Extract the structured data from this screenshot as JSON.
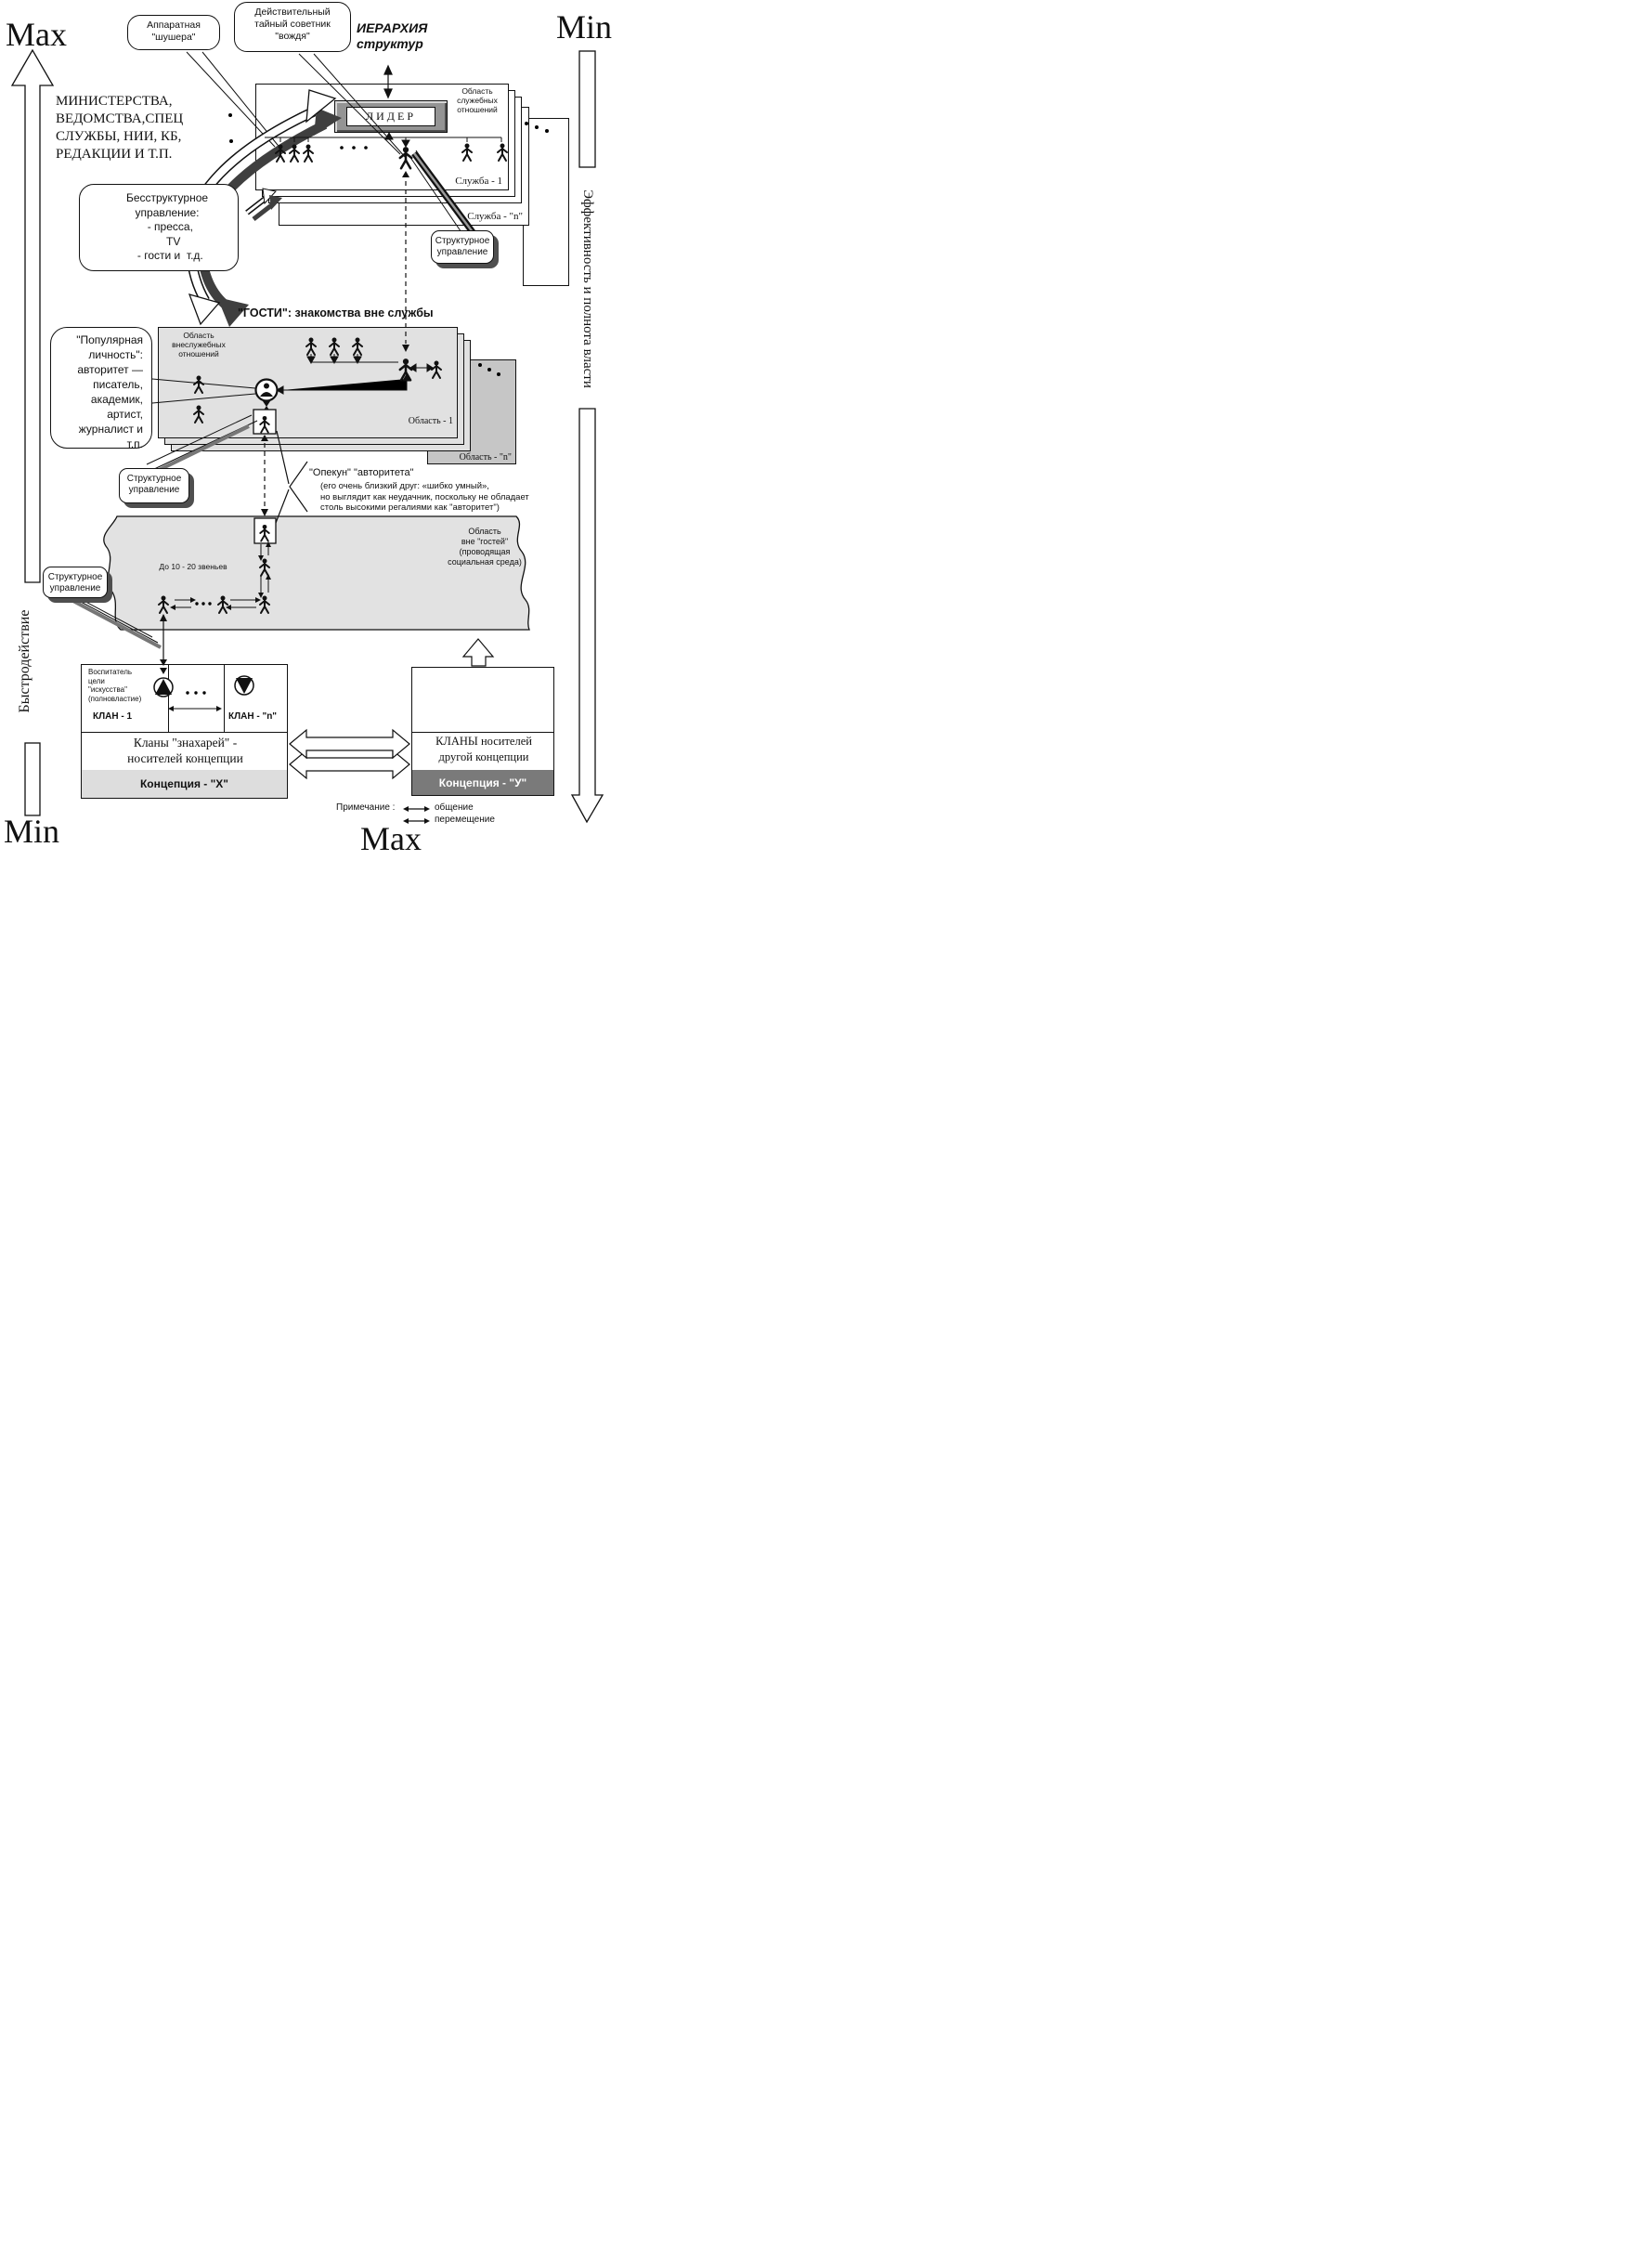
{
  "axes": {
    "left": {
      "top": "Max",
      "label": "Быстродействие",
      "bottom": "Min"
    },
    "right": {
      "top": "Min",
      "label": "Эффективность и полнота власти",
      "bottom": "Max"
    }
  },
  "callouts": {
    "apparat": "Аппаратная\n\"шушера\"",
    "advisor": "Действительный\nтайный советник\n\"вождя\"",
    "hierarchy_title": "ИЕРАРХИЯ\nструктур",
    "nonstructural": "Бесструктурное\nуправление:\n  - пресса,\n    TV\n  - гости и  т.д.",
    "structural": "Структурное\nуправление",
    "popular_person": "\"Популярная\nличность\":\nавторитет —\nписатель,\nакадемик,\nартист,\nжурналист и\nт.п.",
    "guardian_title": "\"Опекун\" \"авторитета\"",
    "guardian_note": "(его очень близкий друг: «шибко умный»,\nно выглядит как неудачник, поскольку не обладает\nстоль высокими регалиями как \"авторитет\")"
  },
  "ministries": "МИНИСТЕРСТВА,\nВЕДОМСТВА,СПЕЦ\nСЛУЖБЫ, НИИ, КБ,\nРЕДАКЦИИ И Т.П.",
  "services": {
    "leader": "ЛИДЕР",
    "area_note": "Область\nслужебных\nотношений",
    "service_1": "Служба - 1",
    "service_n": "Служба - \"n\""
  },
  "guests": {
    "heading": "\"ГОСТИ\": знакомства вне службы",
    "area_note": "Область\nвнеслужебных\nотношений",
    "area_1": "Область - 1",
    "area_n": "Область - \"n\""
  },
  "band": {
    "label": "Область\nвне \"гостей\"\n(проводящая\nсоциальная среда)",
    "links": "До 10 - 20 звеньев"
  },
  "clans": {
    "clan1_note": "Воспитатель\nцели\n\"искусства\"\n(полновластие)",
    "clan1": "КЛАН  - 1",
    "clan_n": "КЛАН - \"n\"",
    "left_title": "Кланы \"знахарей\" -\nносителей концепции",
    "left_concept": "Концепция - \"Х\"",
    "right_title": "КЛАНЫ носителей\nдругой концепции",
    "right_concept": "Концепция - \"У\""
  },
  "legend": {
    "title": "Примечание :",
    "item1": "общение",
    "item2": "перемещение"
  }
}
